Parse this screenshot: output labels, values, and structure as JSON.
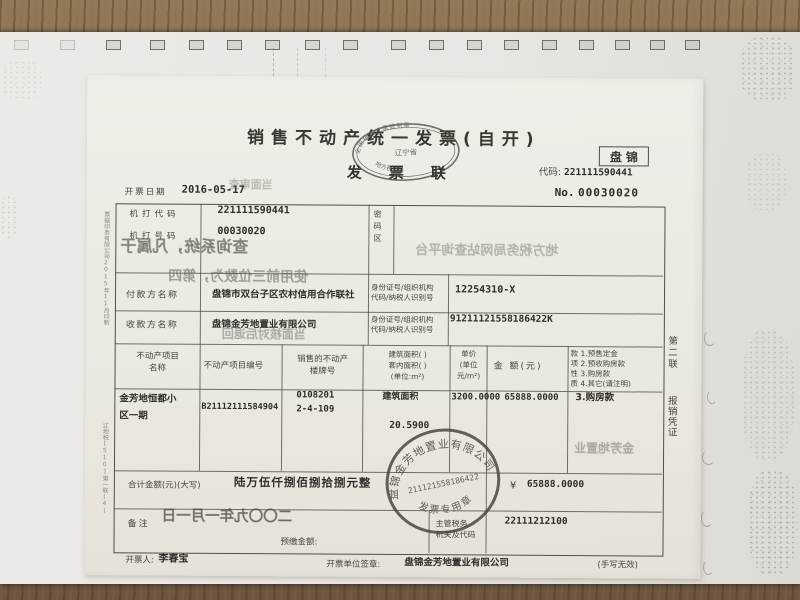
{
  "invoice": {
    "header": {
      "title": "销售不动产统一发票(自开)",
      "copy_name": "发票联",
      "region": "盘锦",
      "code_label": "代码:",
      "code": "221111590441",
      "number_label": "No.",
      "number": "00030020",
      "date_label": "开票日期",
      "date": "2016-05-17",
      "oval_stamp": {
        "top": "全国统一发票监制章",
        "middle": "辽宁省",
        "bottom": "地方税务局"
      }
    },
    "machine": {
      "code_label": "机打代码",
      "code": "221111590441",
      "no_label": "机打号码",
      "no": "00030020",
      "password_label": "密码区"
    },
    "payer": {
      "label": "付款方名称",
      "name": "盘锦市双台子区农村信用合作联社",
      "id_label": "身份证号/组织机构\n代码/纳税人识别号",
      "id": "12254310-X"
    },
    "payee": {
      "label": "收款方名称",
      "name": "盘锦金芳地置业有限公司",
      "id_label": "身份证号/组织机构\n代码/纳税人识别号",
      "id": "91211121558186422K"
    },
    "columns": {
      "name": "不动产项目\n名称",
      "project_no": "不动产项目编号",
      "building": "销售的不动产\n楼牌号",
      "area": "建筑面积( )\n套内面积( )\n(单位:m²)",
      "unit_price": "单价\n(单位\n元/m²)",
      "amount": "金 额(元)"
    },
    "payment_nature": {
      "options": "款 1.预售定金\n项 2.预收购房款\n性 3.购房款\n质 4.其它(请注明)",
      "selected": "3.购房款"
    },
    "item": {
      "name": "金芳地恒都小\n区一期",
      "project_no": "B21112111584904",
      "building_no": "0108201",
      "unit_no": "2-4-109",
      "area_type": "建筑面积",
      "area": "20.5900",
      "unit_price": "3200.0000",
      "amount": "65888.0000"
    },
    "total": {
      "label": "合计金额(元)(大写)",
      "in_words": "陆万伍仟捌佰捌拾捌元整",
      "currency": "¥",
      "amount": "65888.0000"
    },
    "remarks": {
      "label": "备注",
      "prepaid_label": "预缴金额:"
    },
    "tax_authority": {
      "label": "主管税务\n机关及代码",
      "code": "22111212100"
    },
    "footer": {
      "issuer_label": "开票人:",
      "issuer": "李春宝",
      "unit_label": "开票单位签章:",
      "unit": "盘锦金芳地置业有限公司",
      "note": "(手写无效)"
    },
    "margins": {
      "right_copy": "第二联",
      "right_copy_use": "报销凭证",
      "left_print_top": "票据印务有限公司2015年11月印制",
      "left_print_bottom": "辽地税[510]第一联(4)"
    },
    "seal": {
      "company": "盘锦金芳地置业有限公司",
      "number": "211121558186422",
      "caption": "发票专用章"
    },
    "bleed_through": {
      "line1": "查询系统，凡属于",
      "line1b": "地方税务局网站查询平台",
      "line2": "使用前三位数为，第四",
      "line3": "当面核对后退回",
      "header_small": "当面审查",
      "nature_col": "金芳地置业",
      "date": "二〇〇九年一月一日"
    }
  }
}
